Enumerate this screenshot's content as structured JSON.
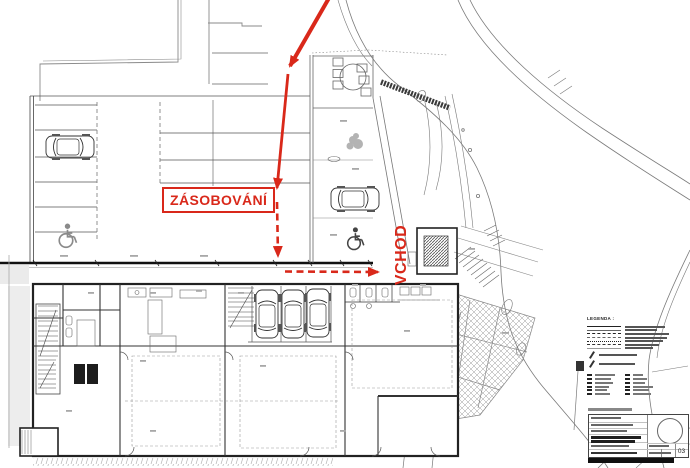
{
  "annotations": {
    "supply_label": "ZÁSOBOVÁNÍ",
    "entrance_label": "VCHOD",
    "route_color": "#d9281a"
  },
  "legend": {
    "title": "LEGENDA :"
  },
  "title_block": {
    "sheet_number": "03"
  }
}
